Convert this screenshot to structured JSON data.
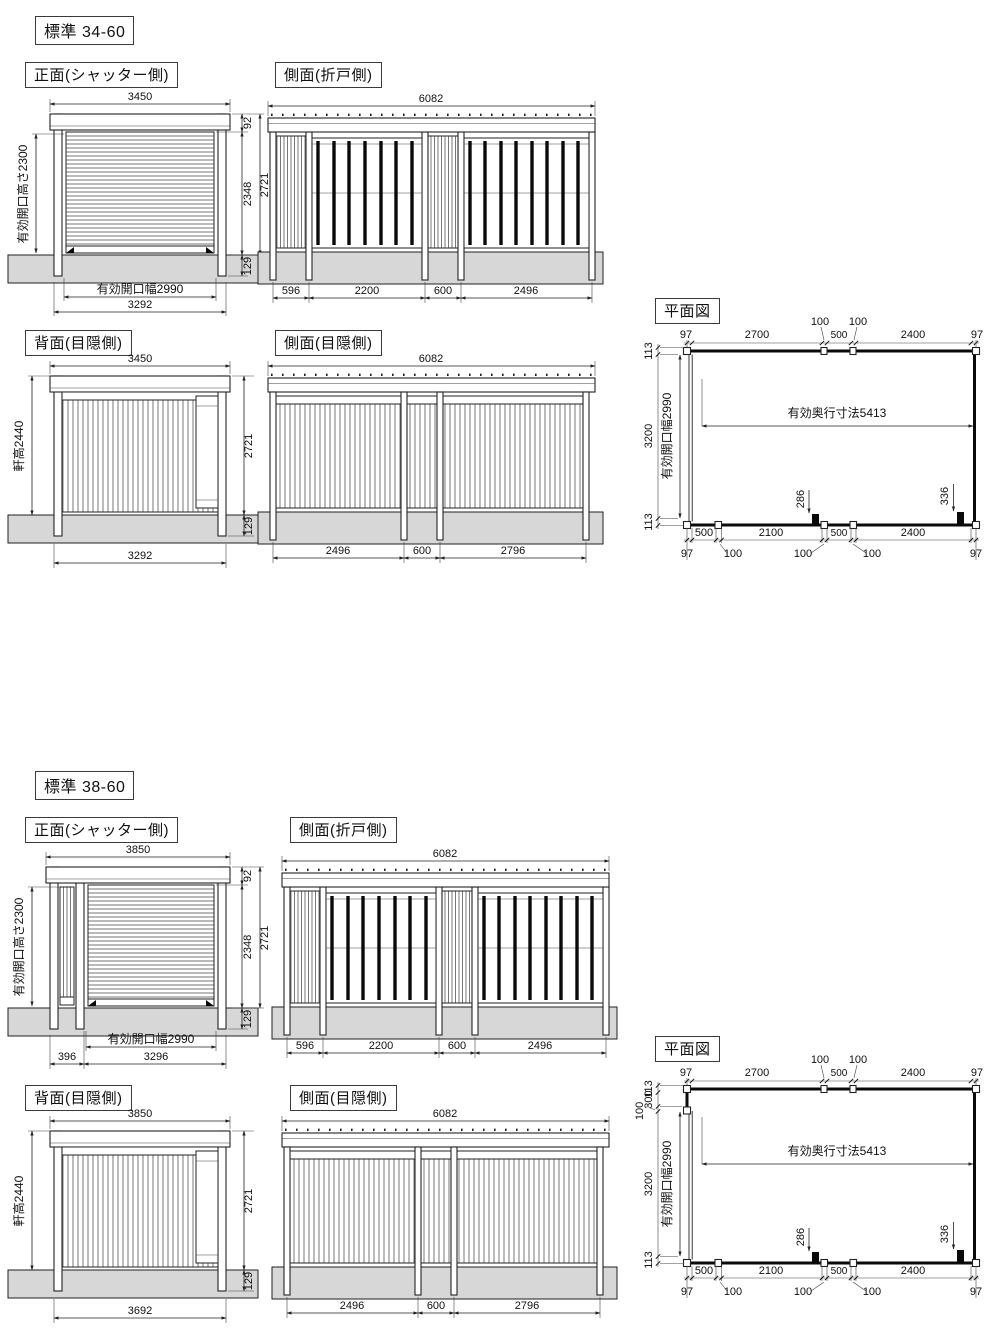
{
  "sections": [
    {
      "title": "標準 34-60",
      "front": {
        "label": "正面(シャッター側)",
        "width_top": "3450",
        "roof_h": "92",
        "total_h": "2721",
        "shutter_h": "2348",
        "below_gl": "129",
        "opening_h": "有効開口高さ2300",
        "opening_w": "有効開口幅2990",
        "width_bottom": "3292"
      },
      "side_fold": {
        "label": "側面(折戸側)",
        "width_top": "6082",
        "d1": "596",
        "d2": "2200",
        "d3": "600",
        "d4": "2496"
      },
      "back": {
        "label": "背面(目隠側)",
        "width_top": "3450",
        "eave_h": "軒高2440",
        "total_h": "2721",
        "below_gl": "129",
        "width_bottom": "3292"
      },
      "side_screen": {
        "label": "側面(目隠側)",
        "width_top": "6082",
        "d1": "2496",
        "d2": "600",
        "d3": "2796"
      },
      "plan": {
        "label": "平面図",
        "top": [
          "97",
          "2700",
          "100",
          "500",
          "100",
          "2400",
          "97"
        ],
        "left": [
          "113",
          "3200",
          "113"
        ],
        "depth": "有効奥行寸法5413",
        "opening": "有効開口幅2990",
        "mark_mid": "286",
        "mark_right": "336",
        "bottom1": [
          "500",
          "2100",
          "500",
          "2400"
        ],
        "bottom2": [
          "97",
          "100",
          "100",
          "100",
          "97"
        ]
      }
    },
    {
      "title": "標準 38-60",
      "front": {
        "label": "正面(シャッター側)",
        "width_top": "3850",
        "roof_h": "92",
        "total_h": "2721",
        "shutter_h": "2348",
        "below_gl": "129",
        "opening_h": "有効開口高さ2300",
        "opening_w": "有効開口幅2990",
        "side_panel": "396",
        "width_bottom": "3296"
      },
      "side_fold": {
        "label": "側面(折戸側)",
        "width_top": "6082",
        "d1": "596",
        "d2": "2200",
        "d3": "600",
        "d4": "2496"
      },
      "back": {
        "label": "背面(目隠側)",
        "width_top": "3850",
        "eave_h": "軒高2440",
        "total_h": "2721",
        "below_gl": "129",
        "width_bottom": "3692"
      },
      "side_screen": {
        "label": "側面(目隠側)",
        "width_top": "6082",
        "d1": "2496",
        "d2": "600",
        "d3": "2796"
      },
      "plan": {
        "label": "平面図",
        "top": [
          "97",
          "2700",
          "100",
          "500",
          "100",
          "2400",
          "97"
        ],
        "left": [
          "113",
          "300",
          "100",
          "3200",
          "113"
        ],
        "depth": "有効奥行寸法5413",
        "opening": "有効開口幅2990",
        "mark_mid": "286",
        "mark_right": "336",
        "bottom1": [
          "500",
          "2100",
          "500",
          "2400"
        ],
        "bottom2": [
          "97",
          "100",
          "100",
          "100",
          "97"
        ]
      }
    }
  ]
}
